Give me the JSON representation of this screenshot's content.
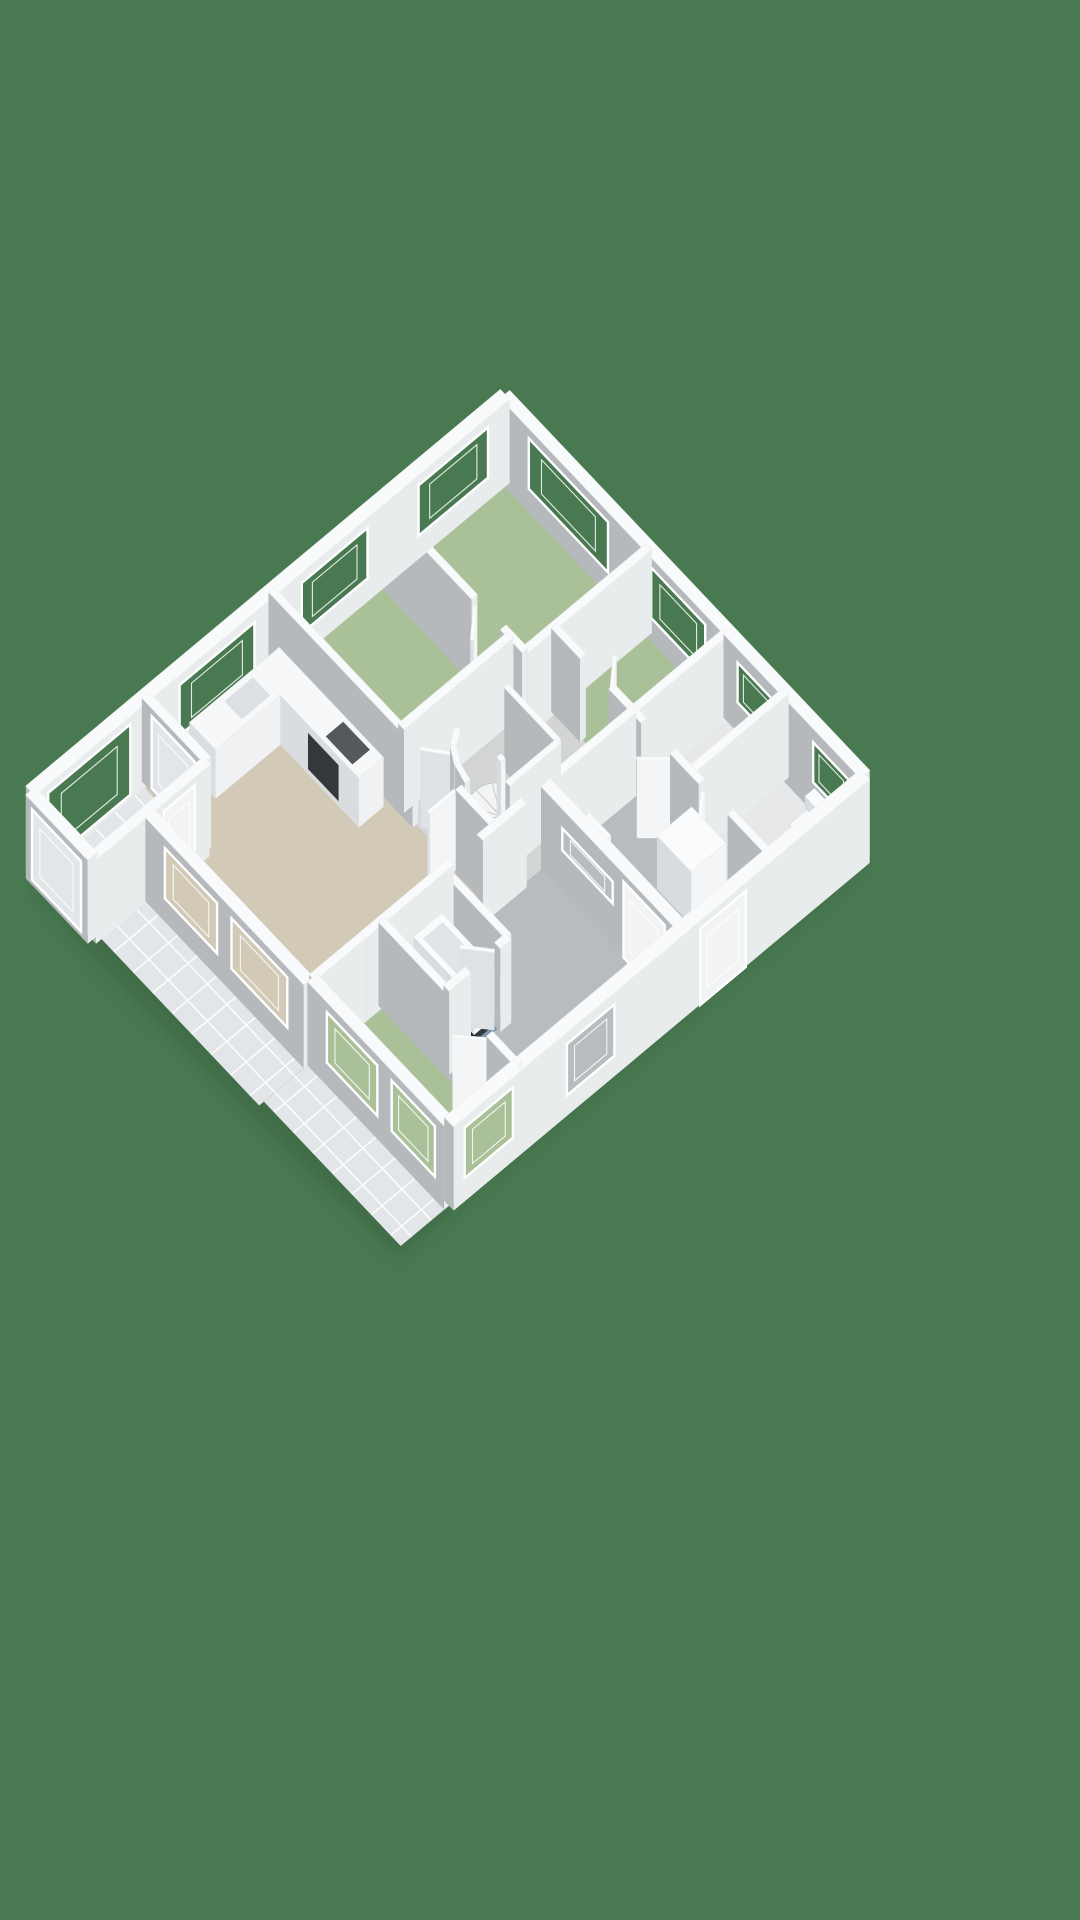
{
  "canvas": {
    "width": 1080,
    "height": 1920
  },
  "background_color": "#497951",
  "palette": {
    "bg": "#497951",
    "wall_top": "#f9fafb",
    "wall_light": "#e9eced",
    "wall_gray": "#b5b9bc",
    "door_light": "#f3f5f6",
    "door_gray": "#dfe2e4",
    "door_top": "#fafbfc",
    "fix_light": "#f3f5f6",
    "fix_gray": "#d9dcde",
    "fix_top": "#fafbfc",
    "floor_green": "#a9c099",
    "floor_beige": "#d2c9b6",
    "floor_gray": "#b8bcbf",
    "floor_hall": "#d3d5d4",
    "floor_white": "#e6e8ea",
    "floor_blue": "#7e93ab",
    "tile": "#e3e6e8",
    "tile_line": "#ffffff",
    "door": "#f1f3f4",
    "dark": "#34383b",
    "shadow": "#16301f"
  },
  "projection": {
    "origin": [
      505,
      478
    ],
    "eu": [
      0.36,
      0.38
    ],
    "ev": [
      -0.365,
      0.305
    ],
    "ez": 0.95,
    "wall_height": 88
  },
  "shadow_poly": [
    [
      0,
      0
    ],
    [
      1000,
      0
    ],
    [
      1000,
      1280
    ],
    [
      640,
      1300
    ],
    [
      175,
      1315
    ],
    [
      0,
      1300
    ]
  ],
  "floors": [
    {
      "name": "terrace-south",
      "tiles": true,
      "poly": [
        [
          180,
          1150
        ],
        [
          620,
          1150
        ],
        [
          620,
          1285
        ],
        [
          180,
          1285
        ]
      ]
    },
    {
      "name": "terrace-east",
      "tiles": true,
      "poly": [
        [
          620,
          1140
        ],
        [
          1000,
          1140
        ],
        [
          1000,
          1272
        ],
        [
          620,
          1272
        ]
      ]
    },
    {
      "name": "balcony",
      "tiles": true,
      "poly": [
        [
          0,
          985
        ],
        [
          172,
          985
        ],
        [
          172,
          1300
        ],
        [
          0,
          1300
        ]
      ]
    },
    {
      "name": "landing-east",
      "color": "floor_gray",
      "poly": [
        [
          620,
          260
        ],
        [
          1000,
          260
        ],
        [
          1000,
          950
        ],
        [
          620,
          950
        ]
      ]
    },
    {
      "name": "hall-center",
      "color": "floor_hall",
      "poly": [
        [
          400,
          260
        ],
        [
          620,
          260
        ],
        [
          620,
          640
        ],
        [
          360,
          640
        ],
        [
          360,
          340
        ],
        [
          400,
          340
        ]
      ]
    },
    {
      "name": "shower-room",
      "color": "floor_white",
      "poly": [
        [
          620,
          0
        ],
        [
          780,
          0
        ],
        [
          780,
          260
        ],
        [
          620,
          260
        ]
      ]
    },
    {
      "name": "wc-room",
      "color": "floor_white",
      "poly": [
        [
          780,
          0
        ],
        [
          1000,
          0
        ],
        [
          1000,
          260
        ],
        [
          780,
          260
        ]
      ]
    },
    {
      "name": "bedroom-north",
      "color": "floor_green",
      "poly": [
        [
          0,
          0
        ],
        [
          400,
          0
        ],
        [
          400,
          340
        ],
        [
          0,
          340
        ]
      ]
    },
    {
      "name": "bedroom-east",
      "color": "floor_green",
      "poly": [
        [
          400,
          0
        ],
        [
          620,
          0
        ],
        [
          620,
          260
        ],
        [
          400,
          260
        ]
      ]
    },
    {
      "name": "bedroom-west",
      "color": "floor_green",
      "poly": [
        [
          0,
          340
        ],
        [
          360,
          340
        ],
        [
          360,
          640
        ],
        [
          0,
          640
        ]
      ]
    },
    {
      "name": "living-room",
      "color": "floor_beige",
      "poly": [
        [
          0,
          640
        ],
        [
          620,
          640
        ],
        [
          620,
          1150
        ],
        [
          180,
          1150
        ],
        [
          180,
          1000
        ],
        [
          0,
          1000
        ]
      ]
    },
    {
      "name": "bathroom",
      "color": "floor_blue",
      "poly": [
        [
          620,
          780
        ],
        [
          800,
          780
        ],
        [
          800,
          950
        ],
        [
          620,
          950
        ]
      ]
    },
    {
      "name": "bedroom-south",
      "color": "floor_green",
      "poly": [
        [
          620,
          950
        ],
        [
          1000,
          950
        ],
        [
          1000,
          1140
        ],
        [
          620,
          1140
        ]
      ]
    }
  ],
  "walls": [
    {
      "name": "ext-ne-west",
      "a": [
        0,
        0
      ],
      "b": [
        620,
        0
      ],
      "t": 26,
      "openings": [
        [
          80,
          300,
          25,
          78,
          "bg"
        ],
        [
          420,
          570,
          25,
          78,
          "bg"
        ]
      ]
    },
    {
      "name": "ext-ne-east",
      "a": [
        620,
        0
      ],
      "b": [
        1000,
        0
      ],
      "t": 26,
      "openings": [
        [
          40,
          140,
          32,
          74,
          "bg"
        ],
        [
          250,
          350,
          32,
          74,
          "bg"
        ]
      ]
    },
    {
      "name": "ext-east",
      "a": [
        1000,
        0
      ],
      "b": [
        1000,
        950
      ],
      "t": 26,
      "openings": [
        [
          340,
          465,
          0,
          80,
          "door"
        ],
        [
          700,
          830,
          22,
          76,
          "floor_gray"
        ]
      ]
    },
    {
      "name": "ext-se-wing",
      "a": [
        620,
        500
      ],
      "b": [
        1000,
        500
      ],
      "t": 26,
      "openings": [
        [
          60,
          200,
          45,
          68,
          "floor_gray"
        ],
        [
          230,
          345,
          0,
          80,
          "door"
        ]
      ]
    },
    {
      "name": "ext-nw",
      "a": [
        0,
        0
      ],
      "b": [
        0,
        1300
      ],
      "t": 26,
      "openings": [
        [
          60,
          250,
          25,
          78,
          "bg"
        ],
        [
          390,
          570,
          25,
          78,
          "bg"
        ],
        [
          700,
          905,
          25,
          78,
          "bg"
        ],
        [
          1040,
          1265,
          6,
          80,
          "bg"
        ]
      ]
    },
    {
      "name": "ext-balcony-end",
      "a": [
        0,
        1300
      ],
      "b": [
        172,
        1300
      ],
      "t": 26,
      "openings": [
        [
          18,
          154,
          6,
          80,
          "tile"
        ]
      ]
    },
    {
      "name": "balcony-east",
      "a": [
        172,
        985
      ],
      "b": [
        172,
        1300
      ],
      "t": 20,
      "openings": [
        [
          45,
          130,
          4,
          80,
          "door"
        ]
      ]
    },
    {
      "name": "kitchen-balcony",
      "a": [
        0,
        985
      ],
      "b": [
        172,
        985
      ],
      "t": 20,
      "openings": [
        [
          28,
          148,
          4,
          80,
          "tile"
        ]
      ]
    },
    {
      "name": "ext-west-living",
      "a": [
        180,
        1000
      ],
      "b": [
        180,
        1150
      ],
      "t": 26
    },
    {
      "name": "ext-sw-living",
      "a": [
        180,
        1150
      ],
      "b": [
        620,
        1150
      ],
      "t": 26,
      "openings": [
        [
          55,
          200,
          25,
          78,
          "floor_beige"
        ],
        [
          240,
          395,
          25,
          78,
          "floor_beige"
        ]
      ]
    },
    {
      "name": "ext-se-bedroom-south",
      "a": [
        620,
        1140
      ],
      "b": [
        1000,
        1140
      ],
      "t": 26,
      "openings": [
        [
          55,
          195,
          25,
          78,
          "floor_green"
        ],
        [
          235,
          355,
          25,
          78,
          "floor_green"
        ]
      ]
    },
    {
      "name": "ext-east-bedroom-south",
      "a": [
        1000,
        950
      ],
      "b": [
        1000,
        1140
      ],
      "t": 26,
      "openings": [
        [
          28,
          160,
          25,
          78,
          "floor_green"
        ]
      ]
    },
    {
      "name": "int-bedn-east",
      "a": [
        400,
        0
      ],
      "b": [
        400,
        340
      ]
    },
    {
      "name": "int-bede-east",
      "a": [
        620,
        0
      ],
      "b": [
        620,
        260
      ]
    },
    {
      "name": "int-shower-east",
      "a": [
        780,
        0
      ],
      "b": [
        780,
        260
      ]
    },
    {
      "name": "int-bedn-south-a",
      "a": [
        0,
        340
      ],
      "b": [
        260,
        340
      ]
    },
    {
      "name": "int-bedn-south-b",
      "a": [
        340,
        340
      ],
      "b": [
        400,
        340
      ]
    },
    {
      "name": "int-bedw-east",
      "a": [
        360,
        340
      ],
      "b": [
        360,
        640
      ]
    },
    {
      "name": "int-living-north-a",
      "a": [
        0,
        640
      ],
      "b": [
        400,
        640
      ]
    },
    {
      "name": "int-living-north-b",
      "a": [
        520,
        640
      ],
      "b": [
        620,
        640
      ]
    },
    {
      "name": "int-bede-south-a",
      "a": [
        400,
        260
      ],
      "b": [
        480,
        260
      ]
    },
    {
      "name": "int-bede-south-b",
      "a": [
        560,
        260
      ],
      "b": [
        620,
        260
      ]
    },
    {
      "name": "int-landing-north-a",
      "a": [
        620,
        260
      ],
      "b": [
        650,
        260
      ]
    },
    {
      "name": "int-landing-north-b",
      "a": [
        730,
        260
      ],
      "b": [
        810,
        260
      ]
    },
    {
      "name": "int-landing-north-c",
      "a": [
        890,
        260
      ],
      "b": [
        1000,
        260
      ]
    },
    {
      "name": "int-hall-east-a",
      "a": [
        620,
        260
      ],
      "b": [
        620,
        480
      ]
    },
    {
      "name": "int-hall-east-b",
      "a": [
        620,
        560
      ],
      "b": [
        620,
        640
      ]
    },
    {
      "name": "int-living-east-a",
      "a": [
        620,
        640
      ],
      "b": [
        620,
        680
      ]
    },
    {
      "name": "int-living-east-b",
      "a": [
        620,
        760
      ],
      "b": [
        620,
        1000
      ]
    },
    {
      "name": "int-living-east-c",
      "a": [
        620,
        1000
      ],
      "b": [
        620,
        1140
      ]
    },
    {
      "name": "int-bath-north",
      "a": [
        620,
        780
      ],
      "b": [
        800,
        780
      ]
    },
    {
      "name": "int-bath-east-a",
      "a": [
        800,
        780
      ],
      "b": [
        800,
        810
      ]
    },
    {
      "name": "int-bath-east-b",
      "a": [
        800,
        890
      ],
      "b": [
        800,
        950
      ]
    },
    {
      "name": "int-beds-north-a",
      "a": [
        620,
        950
      ],
      "b": [
        840,
        950
      ]
    },
    {
      "name": "int-beds-north-b",
      "a": [
        920,
        950
      ],
      "b": [
        1000,
        950
      ]
    },
    {
      "name": "int-stair-north",
      "a": [
        430,
        420
      ],
      "b": [
        575,
        420
      ],
      "t": 12
    },
    {
      "name": "int-stair-east",
      "a": [
        575,
        420
      ],
      "b": [
        575,
        560
      ],
      "t": 12
    },
    {
      "name": "int-stair-arc-a",
      "a": [
        432,
        556
      ],
      "b": [
        452,
        588
      ],
      "t": 12
    },
    {
      "name": "int-stair-arc-b",
      "a": [
        452,
        588
      ],
      "b": [
        484,
        608
      ],
      "t": 12
    },
    {
      "name": "int-stair-arc-c",
      "a": [
        484,
        608
      ],
      "b": [
        522,
        618
      ],
      "t": 12
    },
    {
      "name": "door-living-a",
      "a": [
        408,
        634
      ],
      "b": [
        462,
        586
      ],
      "t": 7,
      "h": 82,
      "style": "door"
    },
    {
      "name": "door-living-b",
      "a": [
        512,
        642
      ],
      "b": [
        512,
        714
      ],
      "t": 7,
      "h": 82,
      "style": "door"
    },
    {
      "name": "door-wc",
      "a": [
        818,
        264
      ],
      "b": [
        862,
        318
      ],
      "t": 7,
      "h": 82,
      "style": "door"
    },
    {
      "name": "door-shower",
      "a": [
        732,
        264
      ],
      "b": [
        688,
        318
      ],
      "t": 7,
      "h": 82,
      "style": "door"
    },
    {
      "name": "door-bathroom",
      "a": [
        796,
        814
      ],
      "b": [
        748,
        860
      ],
      "t": 7,
      "h": 82,
      "style": "door"
    },
    {
      "name": "door-bedroom-south",
      "a": [
        916,
        954
      ],
      "b": [
        870,
        1002
      ],
      "t": 7,
      "h": 82,
      "style": "door"
    },
    {
      "name": "door-bedroom-north",
      "a": [
        266,
        344
      ],
      "b": [
        312,
        398
      ],
      "t": 7,
      "h": 82,
      "style": "door"
    },
    {
      "name": "door-bedroom-east",
      "a": [
        556,
        256
      ],
      "b": [
        510,
        202
      ],
      "t": 7,
      "h": 82,
      "style": "door"
    }
  ],
  "fixtures": [
    {
      "name": "spiral-staircase",
      "type": "spiral",
      "cx": 498,
      "cy": 502,
      "r": 70
    },
    {
      "name": "stair-newel",
      "type": "box",
      "x": 492,
      "y": 496,
      "w": 12,
      "d": 12,
      "z1": 66
    },
    {
      "name": "bathtub-plinth",
      "type": "box",
      "x": 630,
      "y": 794,
      "w": 160,
      "d": 70,
      "z1": 10,
      "light": "#34383a",
      "dark": "#26292b",
      "top": "#34383a"
    },
    {
      "name": "bathtub",
      "type": "box",
      "x": 626,
      "y": 790,
      "w": 168,
      "d": 78,
      "z0": 10,
      "z1": 46
    },
    {
      "name": "bathtub-basin",
      "type": "flat",
      "z": 46,
      "bias": 40,
      "color": "#e2e5e7",
      "poly": [
        [
          640,
          802
        ],
        [
          780,
          802
        ],
        [
          780,
          856
        ],
        [
          640,
          856
        ]
      ]
    },
    {
      "name": "washing-machine",
      "type": "box",
      "x": 790,
      "y": 268,
      "w": 95,
      "d": 95,
      "z1": 56
    },
    {
      "name": "washbasin",
      "type": "box",
      "x": 648,
      "y": 408,
      "w": 60,
      "d": 44,
      "z0": 22,
      "z1": 38
    },
    {
      "name": "washbasin-pedestal",
      "type": "box",
      "x": 662,
      "y": 416,
      "w": 32,
      "d": 28,
      "z1": 22,
      "light": "#e8eaec",
      "dark": "#d4d7d9"
    },
    {
      "name": "toilet-shower-cistern",
      "type": "box",
      "x": 696,
      "y": 26,
      "w": 56,
      "d": 26,
      "z0": 8,
      "z1": 36
    },
    {
      "name": "toilet-shower-bowl",
      "type": "box",
      "x": 702,
      "y": 52,
      "w": 44,
      "d": 48,
      "z1": 24
    },
    {
      "name": "toilet-wc-cistern",
      "type": "box",
      "x": 886,
      "y": 26,
      "w": 56,
      "d": 26,
      "z0": 8,
      "z1": 36
    },
    {
      "name": "toilet-wc-bowl",
      "type": "box",
      "x": 892,
      "y": 52,
      "w": 44,
      "d": 48,
      "z1": 24
    },
    {
      "name": "kitchen-counter",
      "type": "box",
      "x": 44,
      "y": 662,
      "w": 290,
      "d": 68,
      "z1": 52,
      "light": "#eff1f2",
      "dark": "#dadde0",
      "top": "#f6f8f9"
    },
    {
      "name": "kitchen-counter-side",
      "type": "box",
      "x": 44,
      "y": 730,
      "w": 72,
      "d": 178,
      "z1": 52,
      "light": "#eff1f2",
      "dark": "#dadde0",
      "top": "#f6f8f9"
    },
    {
      "name": "oven",
      "type": "facequad",
      "color": "#34383b",
      "pts": [
        [
          194,
          731,
          6
        ],
        [
          279,
          731,
          6
        ],
        [
          279,
          731,
          44
        ],
        [
          194,
          731,
          44
        ]
      ]
    },
    {
      "name": "cooktop",
      "type": "flat",
      "z": 52,
      "bias": 40,
      "color": "#56595c",
      "poly": [
        [
          232,
          672
        ],
        [
          306,
          672
        ],
        [
          306,
          720
        ],
        [
          232,
          720
        ]
      ]
    },
    {
      "name": "kitchen-sink",
      "type": "flat",
      "z": 52,
      "bias": 60,
      "color": "#dde0e2",
      "poly": [
        [
          56,
          746
        ],
        [
          104,
          746
        ],
        [
          104,
          824
        ],
        [
          56,
          824
        ]
      ]
    }
  ]
}
